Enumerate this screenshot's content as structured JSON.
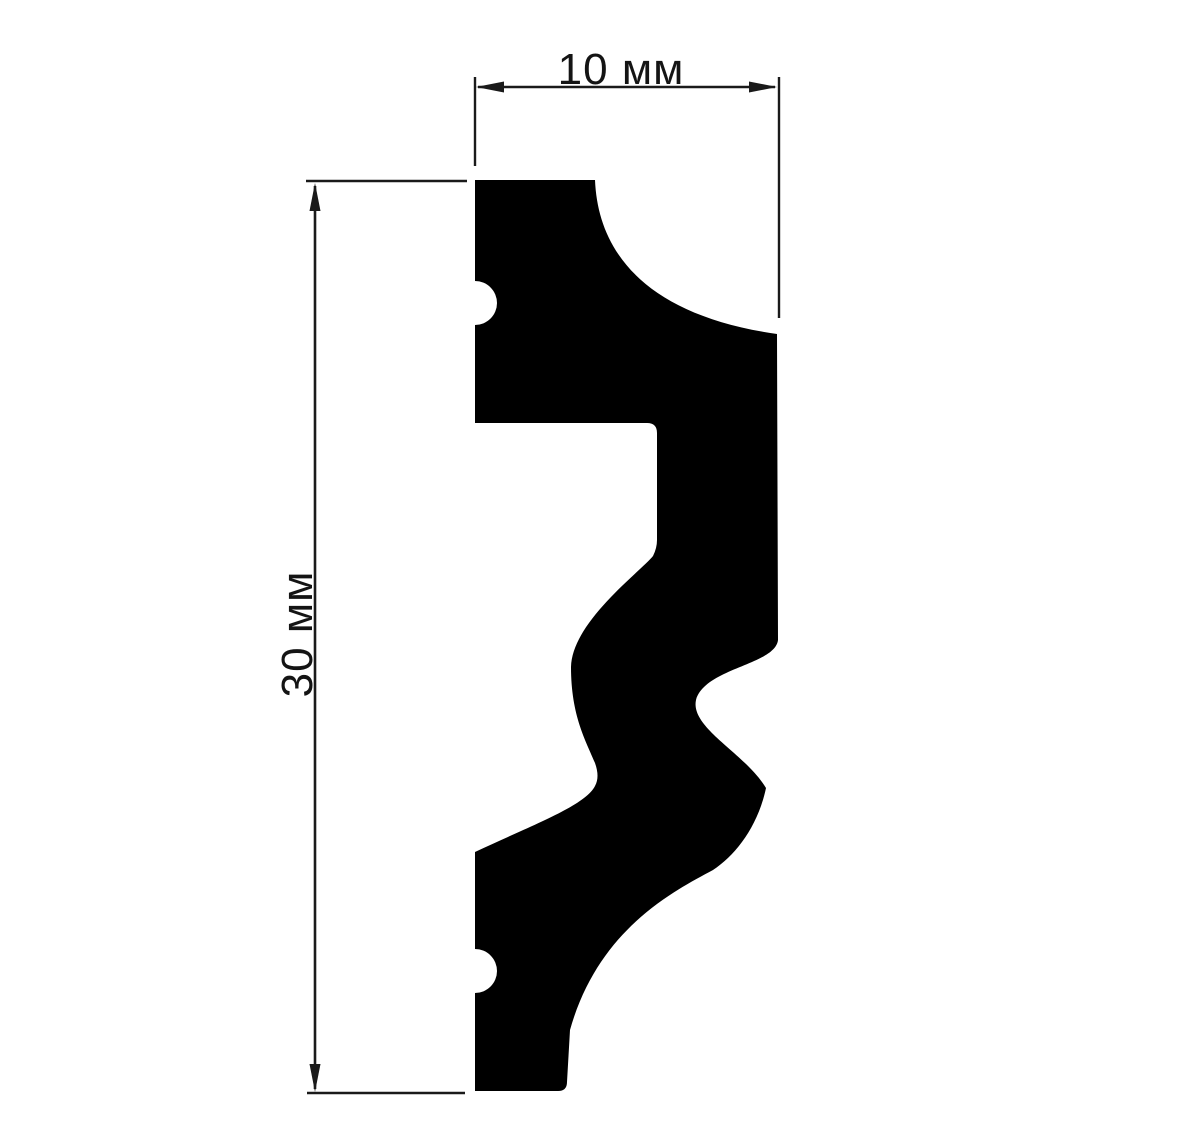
{
  "diagram": {
    "kind": "molding-profile-cross-section",
    "background": "#ffffff",
    "colors": {
      "profile_fill": "#000000",
      "dimension_stroke": "#1a1a1a",
      "label_text": "#141414"
    },
    "dimensions": {
      "width": {
        "label": "10 мм",
        "value": 10,
        "unit": "мм",
        "orientation": "horizontal"
      },
      "height": {
        "label": "30 мм",
        "value": 30,
        "unit": "мм",
        "orientation": "vertical"
      }
    },
    "profile": {
      "path": "M 475,180 L 595,180 C 598,252 645,315 777,334 L 778,640 C 775,665 705,668 696,700 C 690,728 745,753 766,788 C 758,826 736,855 713,870 C 672,892 598,930 570,1030 L 567,1082 Q 567,1091 558,1091 L 475,1091 L 475,993 A 22 22 0 0 0 475,949 L 475,852 C 530,826 585,806 595,786 Q 600,777 595,763 C 586,741 571,716 571,667 C 572,622 640,572 653,556 Q 657,548 657,540 L 657,433 Q 657,423 647,423 L 475,423 L 475,325 A 22 22 0 0 0 475,281 L 475,180 Z"
    }
  }
}
